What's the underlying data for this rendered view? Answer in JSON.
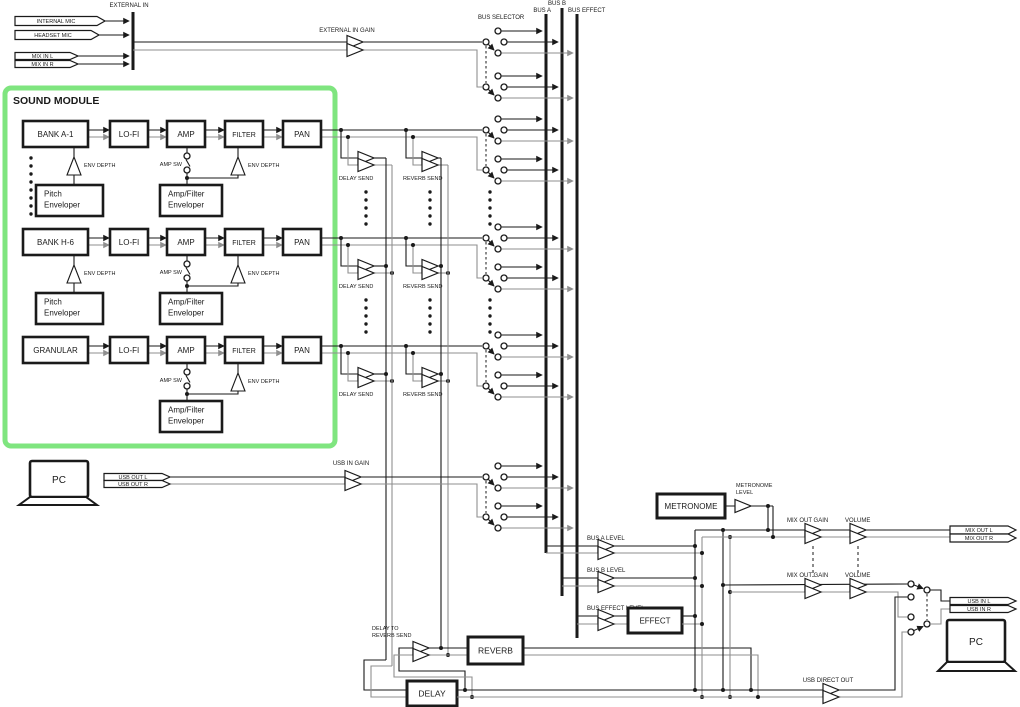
{
  "colors": {
    "line": "#1a1a1a",
    "line2": "#8f8f8f",
    "green": "#7fe57f",
    "bg": "#ffffff"
  },
  "io": {
    "external_in": "EXTERNAL IN",
    "internal_mic": "INTERNAL MIC",
    "headset_mic": "HEADSET MIC",
    "mix_in_l": "MIX IN L",
    "mix_in_r": "MIX IN R",
    "external_in_gain": "EXTERNAL IN GAIN",
    "usb_out_l": "USB OUT L",
    "usb_out_r": "USB OUT R",
    "usb_in_gain": "USB IN GAIN",
    "mix_out_l": "MIX OUT L",
    "mix_out_r": "MIX OUT R",
    "usb_in_l": "USB IN L",
    "usb_in_r": "USB IN R",
    "pc_top": "PC",
    "pc_bottom": "PC"
  },
  "buses": {
    "selector": "BUS SELECTOR",
    "bus_a": "BUS A",
    "bus_b": "BUS B",
    "bus_effect": "BUS EFFECT"
  },
  "sound_module": {
    "title": "SOUND MODULE",
    "channels": [
      {
        "source": "BANK A-1",
        "pitch_env": true
      },
      {
        "source": "BANK H-6",
        "pitch_env": true
      },
      {
        "source": "GRANULAR",
        "pitch_env": false
      }
    ],
    "chain": [
      "LO-FI",
      "AMP",
      "FILTER",
      "PAN"
    ],
    "env_depth": "ENV DEPTH",
    "amp_sw": "AMP SW",
    "pitch_enveloper": [
      "Pitch",
      "Enveloper"
    ],
    "amp_filter_enveloper": [
      "Amp/Filter",
      "Enveloper"
    ]
  },
  "sends": {
    "delay_send": "DELAY SEND",
    "reverb_send": "REVERB SEND",
    "delay_to_reverb_send": [
      "DELAY TO",
      "REVERB SEND"
    ]
  },
  "mixer": {
    "bus_a_level": "BUS A LEVEL",
    "bus_b_level": "BUS B LEVEL",
    "bus_effect_level": "BUS EFFECT LEVEL",
    "metronome": "METRONOME",
    "metronome_level": [
      "METRONOME",
      "LEVEL"
    ],
    "mix_out_gain": "MIX OUT GAIN",
    "volume": "VOLUME",
    "usb_direct_out": "USB DIRECT OUT"
  },
  "effects": {
    "effect": "EFFECT",
    "reverb": "REVERB",
    "delay": "DELAY"
  }
}
